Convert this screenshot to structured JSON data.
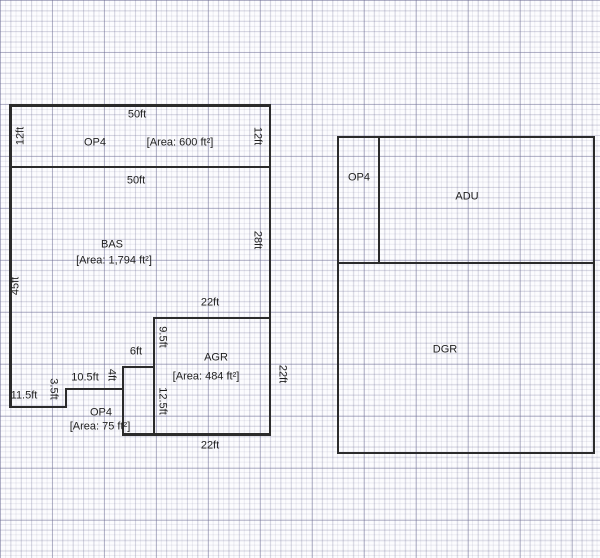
{
  "plan": {
    "left_building": {
      "op4_top": {
        "name": "OP4",
        "area": "[Area: 600 ft²]",
        "dim_top": "50ft",
        "dim_left": "12ft",
        "dim_right": "12ft"
      },
      "bas": {
        "name": "BAS",
        "area": "[Area: 1,794 ft²]",
        "dim_top": "50ft",
        "dim_left": "45ft",
        "dim_right": "28ft"
      },
      "agr": {
        "name": "AGR",
        "area": "[Area: 484 ft²]",
        "dim_top": "22ft",
        "dim_left_upper": "9.5ft",
        "dim_left_lower": "12.5ft",
        "dim_right": "22ft",
        "dim_bottom": "22ft"
      },
      "op4_bottom": {
        "name": "OP4",
        "area": "[Area: 75 ft²]",
        "dim_step_bottom": "11.5ft",
        "dim_step_rise_1": "3.5ft",
        "dim_step_mid": "10.5ft",
        "dim_step_rise_2": "4ft",
        "dim_notch_top": "6ft"
      }
    },
    "right_building": {
      "op4": {
        "name": "OP4"
      },
      "adu": {
        "name": "ADU"
      },
      "dgr": {
        "name": "DGR"
      }
    },
    "colors": {
      "wall": "#2b2b2b",
      "text": "#1f1f1f",
      "grid_fine": "#e6e6f0",
      "grid_major": "#c6c6d4",
      "canvas_background": "#fcfcfe"
    }
  }
}
